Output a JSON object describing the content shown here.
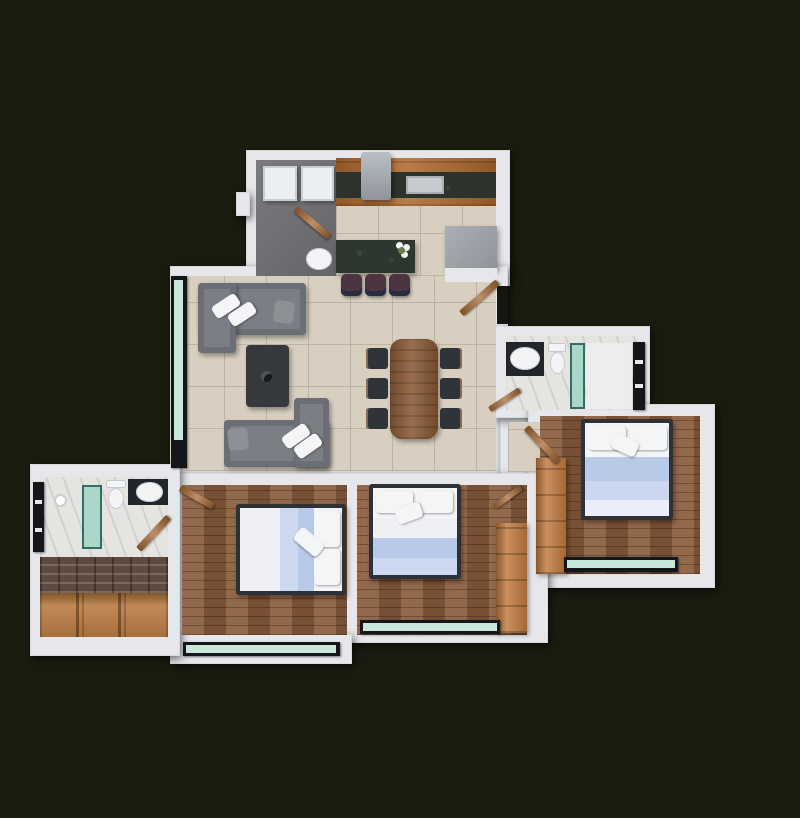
{
  "scene": {
    "type": "3d-rendered-floor-plan",
    "view": "top-down",
    "description": "Photorealistic top-down 3D render of a 3-bedroom 2-bath apartment floor plan on a dark background. No text labels are rendered in the image.",
    "counts": {
      "bedrooms": 3,
      "bathrooms": 2,
      "balconies": 2
    }
  },
  "palette": {
    "background": "#191c0f",
    "wall": "#e6e7ea",
    "tile_floor": "#d8cfc0",
    "wood_floor": "#8a5c3d",
    "marble_floor": "#e6e4e1",
    "utility_floor": "#737377",
    "stone_wall": "#6e584a",
    "shelf_wood": "#b97c42",
    "cabinet_wood": "#b06a2e",
    "counter_granite": "#2b332c",
    "island_granite": "#2d362f",
    "appliance_gray": "#9aa1a7",
    "sofa_gray": "#7b7f85",
    "pillow_gray": "#8d9196",
    "coffee_table": "#35383c",
    "dining_table": "#8a5a36",
    "chair_dark": "#2f343a",
    "stool_plum": "#4a3540",
    "bed_frame": "#2e3237",
    "bed_white": "#f4f5f7",
    "bed_blue": "#b9c9e8",
    "bed_blue_pale": "#cdd9f0",
    "wardrobe_wood": "#c07a3f",
    "shower_glass": "#9fd6c8",
    "window_glass": "#c8e6da",
    "window_frame": "#141619",
    "door_wood": "#a96a35",
    "vanity_dark": "#22262c",
    "ceramic_white": "#f2f4f5"
  },
  "rooms": [
    {
      "id": "laundry",
      "name": "utility-laundry-room",
      "floor": "gray-concrete",
      "furniture": [
        "washing-machine",
        "dryer",
        "round-basin",
        "wood-door"
      ]
    },
    {
      "id": "kitchen",
      "name": "kitchen",
      "floor": "beige-tile",
      "furniture": [
        "counter-with-sink",
        "stove-hood",
        "refrigerator",
        "island-with-flower",
        "three-bar-stools"
      ]
    },
    {
      "id": "living-dining",
      "name": "living-dining-room",
      "floor": "beige-tile",
      "furniture": [
        "l-sofa-top",
        "l-sofa-bottom",
        "coffee-table",
        "dining-table",
        "six-chairs",
        "balcony-sliding-door"
      ]
    },
    {
      "id": "entry",
      "name": "entrance-hall",
      "floor": "beige-tile",
      "furniture": [
        "entrance-door"
      ]
    },
    {
      "id": "bath-right",
      "name": "bathroom-top-right",
      "floor": "marble",
      "furniture": [
        "vanity-sink",
        "toilet",
        "glass-shower",
        "window",
        "wood-door"
      ]
    },
    {
      "id": "bed-right",
      "name": "bedroom-right",
      "floor": "wood-plank",
      "furniture": [
        "double-bed",
        "wardrobe",
        "window",
        "wood-door"
      ]
    },
    {
      "id": "bed-left",
      "name": "bedroom-bottom-left",
      "floor": "wood-plank",
      "furniture": [
        "double-bed",
        "wood-door",
        "balcony-window"
      ]
    },
    {
      "id": "bed-mid",
      "name": "bedroom-bottom-middle",
      "floor": "wood-plank",
      "furniture": [
        "double-bed",
        "wardrobe",
        "window",
        "wood-door"
      ]
    },
    {
      "id": "bath-left",
      "name": "bathroom-bottom-left",
      "floor": "marble",
      "furniture": [
        "glass-shower",
        "toilet",
        "vanity-sink",
        "window",
        "wood-door"
      ]
    },
    {
      "id": "storage",
      "name": "storage-closet",
      "floor": "wood-shelf",
      "furniture": [
        "wooden-shelving",
        "stone-accent-wall"
      ]
    }
  ]
}
